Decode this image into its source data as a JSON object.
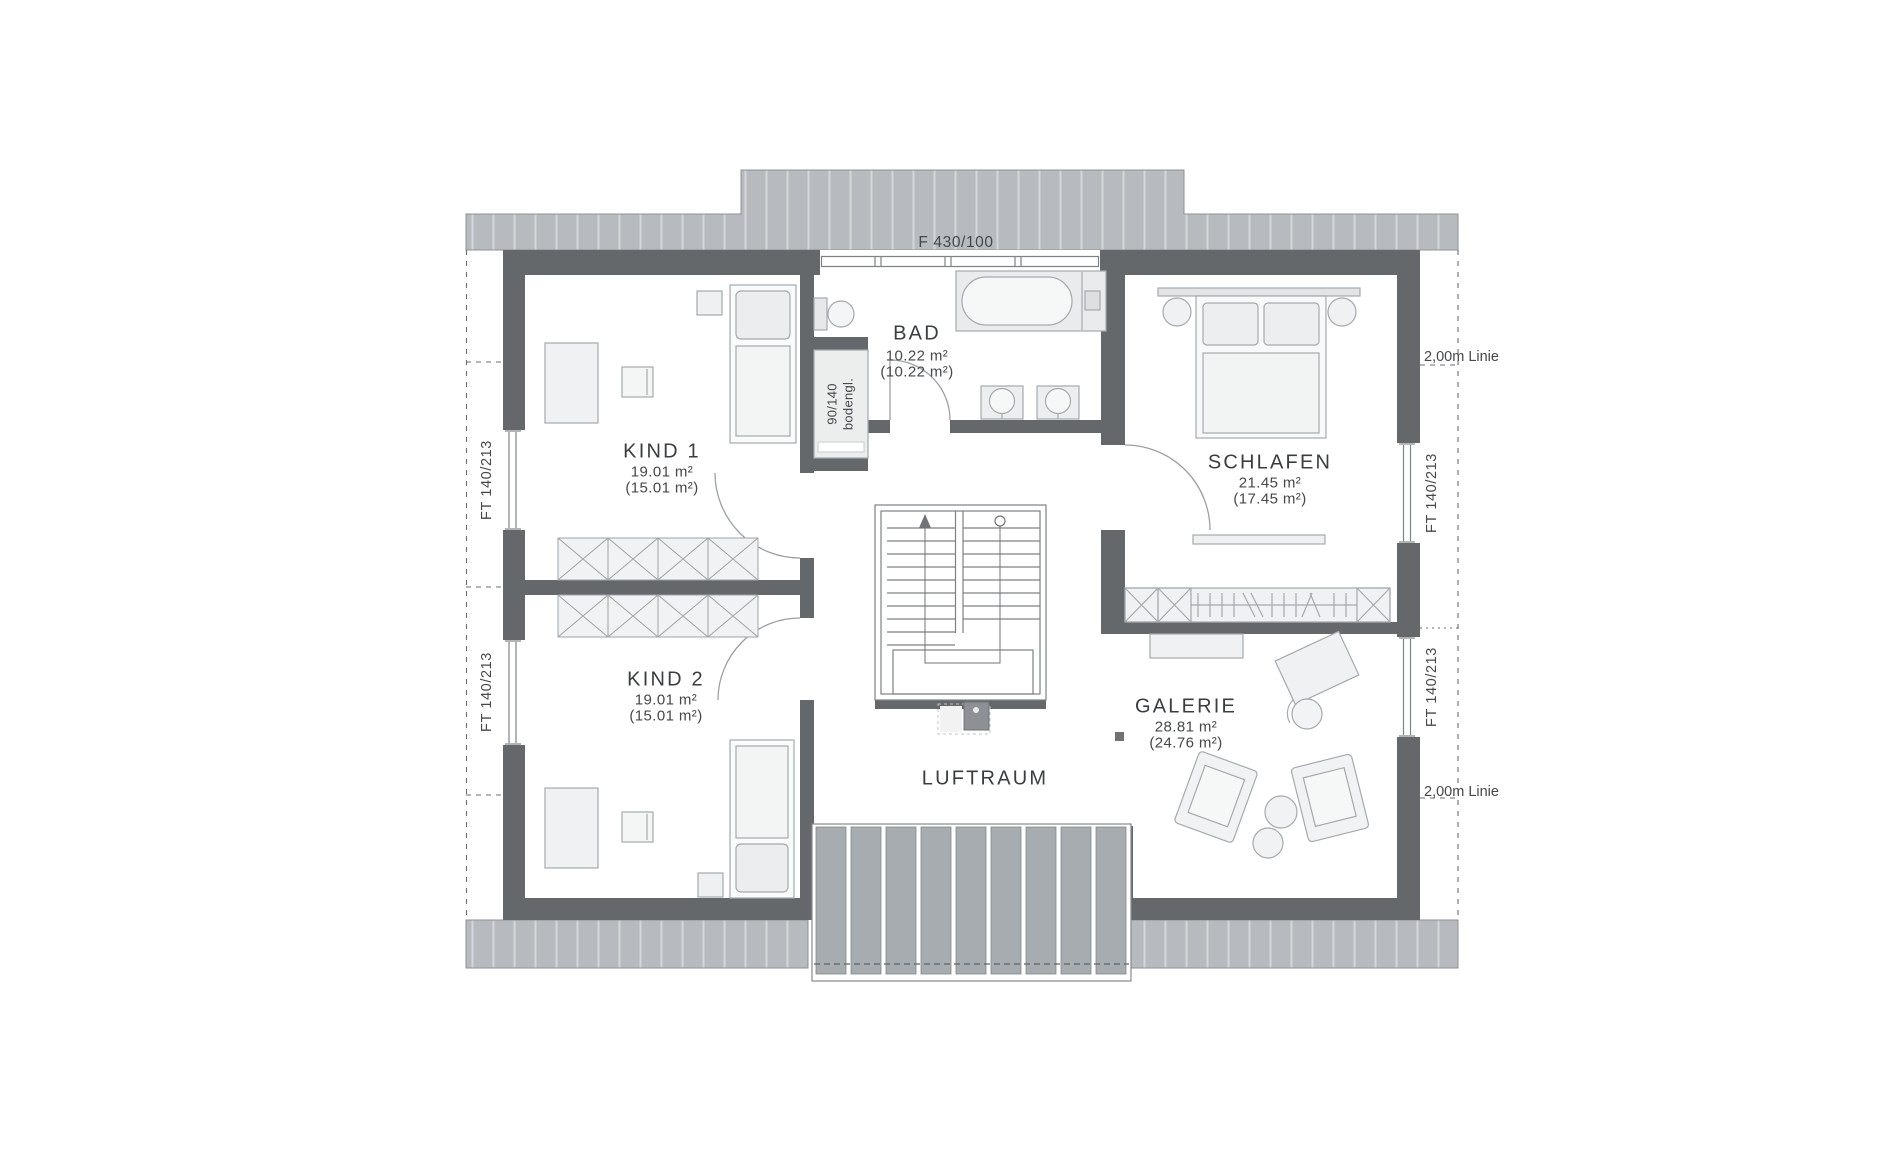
{
  "plan": {
    "labels": {
      "top_window": "F 430/100",
      "side_window": "FT 140/213",
      "two_meter_line": "2,00m Linie",
      "shower_size": "90/140",
      "shower_note": "bodengl."
    },
    "rooms": {
      "kind1": {
        "name": "KIND 1",
        "area_gross": "19.01 m²",
        "area_net": "(15.01 m²)"
      },
      "kind2": {
        "name": "KIND 2",
        "area_gross": "19.01 m²",
        "area_net": "(15.01 m²)"
      },
      "bad": {
        "name": "BAD",
        "area_gross": "10.22 m²",
        "area_net": "(10.22 m²)"
      },
      "schlafen": {
        "name": "SCHLAFEN",
        "area_gross": "21.45 m²",
        "area_net": "(17.45 m²)"
      },
      "galerie": {
        "name": "GALERIE",
        "area_gross": "28.81 m²",
        "area_net": "(24.76 m²)"
      },
      "luftraum": {
        "name": "LUFTRAUM"
      }
    },
    "colors": {
      "wall": "#64686b",
      "roof_strip": "#b7bbbf",
      "roof_hatch": "#d4d7d9",
      "balcony_slat": "#a7acb0",
      "furniture_line": "#a5aaae",
      "dashed_line": "#6a6e71",
      "text": "#3f4346"
    }
  }
}
